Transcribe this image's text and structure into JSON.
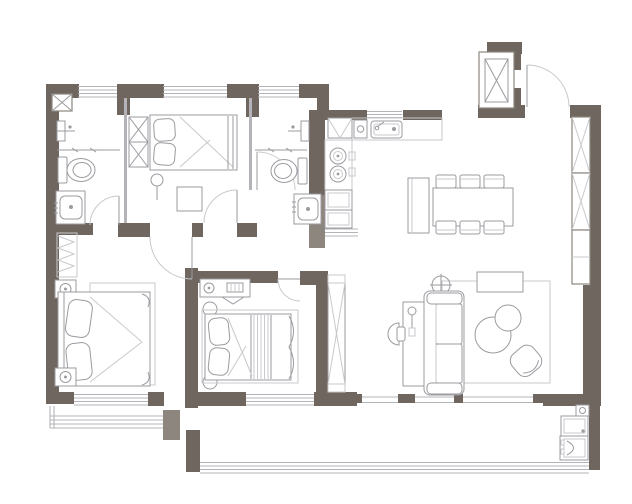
{
  "meta": {
    "title": "apartment-floor-plan",
    "canvas": {
      "width": 632,
      "height": 504
    }
  },
  "colors": {
    "background": "#ffffff",
    "wall": "#6e665f",
    "wall-light": "#8d867f",
    "line": "#9b9ba0",
    "line-light": "#c9c9cd",
    "window": "#b4b4b8"
  },
  "floor_plan": {
    "type": "residential-apartment",
    "rooms": [
      {
        "id": "bathroom-1",
        "label": "bathroom",
        "fixtures": [
          "shower-fixture",
          "glass-partition",
          "toilet",
          "vanity-sink",
          "door-swing",
          "corner-pillar"
        ]
      },
      {
        "id": "bedroom-2",
        "label": "bedroom",
        "fixtures": [
          "wardrobe-x2",
          "single-bed",
          "pillows-x2",
          "floor-lamp",
          "side-table",
          "door-swing"
        ]
      },
      {
        "id": "bathroom-2",
        "label": "bathroom",
        "fixtures": [
          "shower-fixture",
          "glass-partition",
          "toilet",
          "vanity-sink",
          "door-swing"
        ]
      },
      {
        "id": "kitchen",
        "label": "kitchen",
        "fixtures": [
          "fridge",
          "small-appliance",
          "counter",
          "kitchen-sink",
          "cooktop-2-burner",
          "base-cabinets",
          "pass-counter"
        ]
      },
      {
        "id": "entry",
        "label": "entry",
        "fixtures": [
          "entry-door-swing",
          "elevator-shaft",
          "tall-storage-cabinets"
        ]
      },
      {
        "id": "dining",
        "label": "dining area",
        "fixtures": [
          "dining-table",
          "dining-chairs-x6",
          "sideboard"
        ]
      },
      {
        "id": "living",
        "label": "living room",
        "fixtures": [
          "sofa-2-seat",
          "coffee-table-round-x2",
          "armchair",
          "desk",
          "desk-chair",
          "desk-lamp",
          "floor-lamp",
          "rug",
          "console",
          "sliding-balcony-door"
        ]
      },
      {
        "id": "master-bedroom",
        "label": "bedroom",
        "fixtures": [
          "double-bed",
          "pillows-x2",
          "nightstand-lamp-x2",
          "rug",
          "radiator",
          "bay-window",
          "door-swing"
        ]
      },
      {
        "id": "bedroom-3",
        "label": "bedroom",
        "fixtures": [
          "double-bed",
          "pillows-x2",
          "striped-runner",
          "dresser",
          "round-stool-x2",
          "wardrobe",
          "door-swing",
          "window"
        ]
      },
      {
        "id": "balcony",
        "label": "balcony",
        "fixtures": [
          "railing-window",
          "laundry-sink",
          "washing-machine",
          "tap-box"
        ]
      }
    ],
    "window_count": 8,
    "door_swing_count": 6
  }
}
